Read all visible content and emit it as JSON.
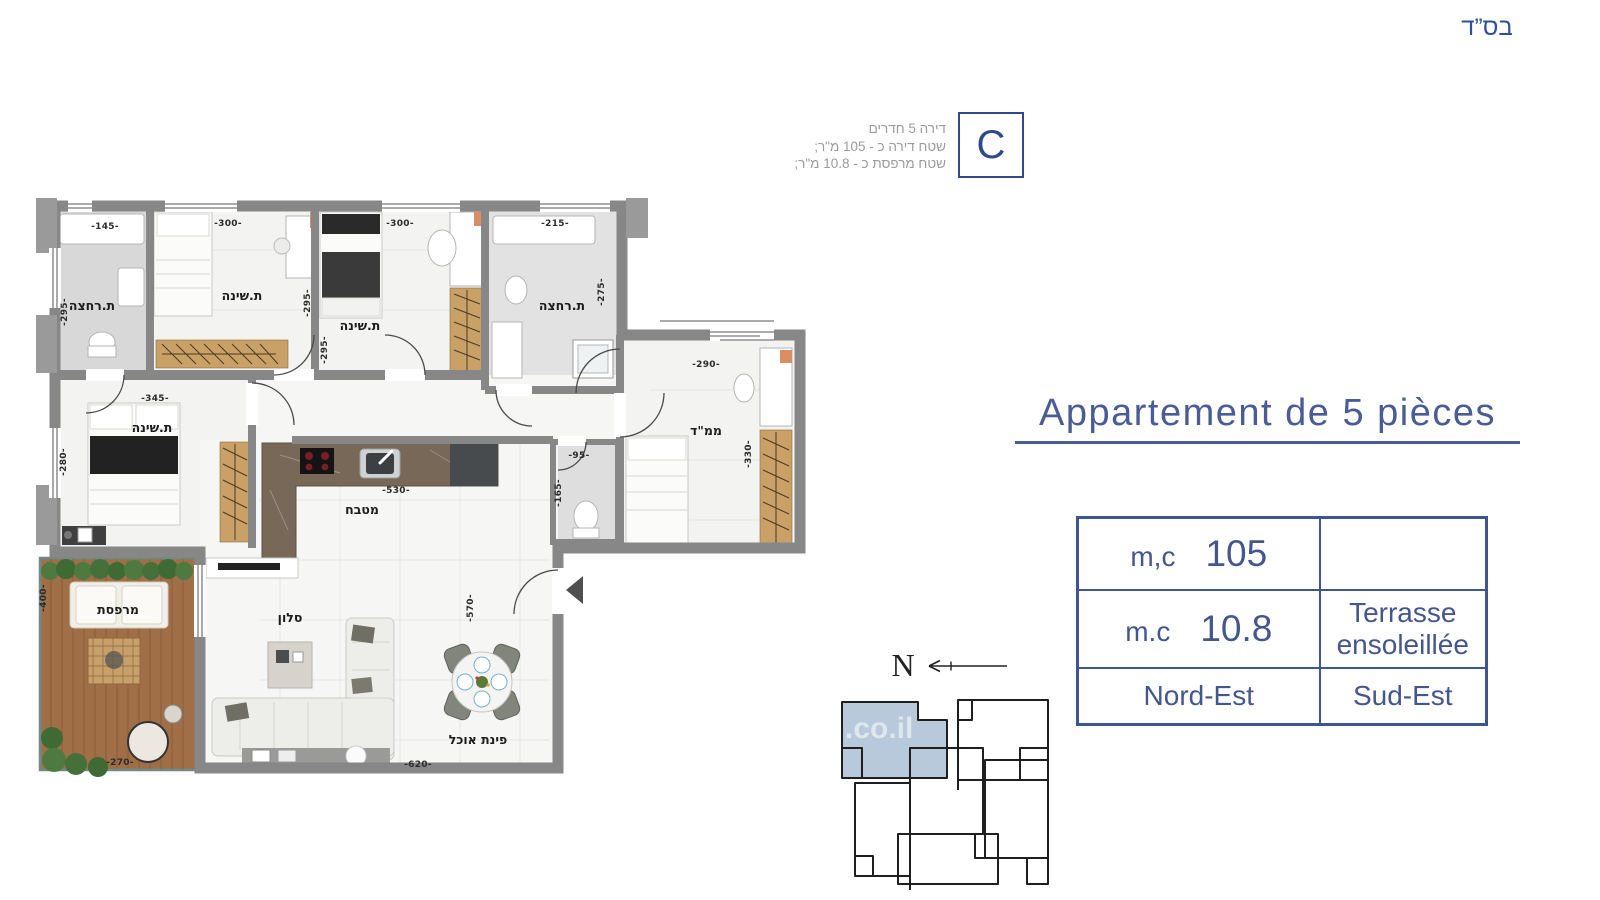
{
  "header": {
    "bsd": "בס”ד"
  },
  "unit_badge": {
    "letter": "C",
    "desc_lines": [
      "דירה 5 חדרים",
      "שטח דירה כ - 105 מ\"ר;",
      "שטח מרפסת כ - 10.8 מ\"ר;"
    ]
  },
  "title": {
    "text": "Appartement de 5 pièces"
  },
  "info_table": {
    "r1_label": "m,c",
    "r1_value": "105",
    "r1_right": "",
    "r2_label": "m.c",
    "r2_value": "10.8",
    "r2_right_line1": "Terrasse",
    "r2_right_line2": "ensoleillée",
    "r3_left": "Nord-Est",
    "r3_right": "Sud-Est"
  },
  "north_indicator": {
    "label": "N"
  },
  "key_plan": {
    "watermark": ".co.il",
    "highlight_color": "#b7c9da"
  },
  "colors": {
    "accent_blue": "#44568e",
    "table_border": "#3d5590",
    "wall_gray": "#878787"
  },
  "floor_plan": {
    "room_labels": {
      "bath1": "ת.רחצה",
      "bed1": "ת.שינה",
      "bed2": "ת.שינה",
      "bath2": "ת.רחצה",
      "master": "ת.שינה",
      "mamad": "ממ\"ד",
      "kitchen": "מטבח",
      "salon": "סלון",
      "dining": "פינת אוכל",
      "terrace": "מרפסת"
    },
    "dims": {
      "bath1_w": "-145-",
      "bath1_h": "-295-",
      "bed1_w": "-300-",
      "bed1_h": "-295-",
      "bed2_w": "-300-",
      "bed2_h": "-295-",
      "bath2_w": "-215-",
      "bath2_h": "-275-",
      "master_w": "-345-",
      "master_h": "-280-",
      "mamad_w": "-290-",
      "mamad_h": "-330-",
      "kitchen_w": "-530-",
      "wc_w": "-95-",
      "wc_h": "-165-",
      "living_h": "-570-",
      "living_w": "-620-",
      "terrace_w": "-270-",
      "terrace_h": "-400-"
    }
  }
}
